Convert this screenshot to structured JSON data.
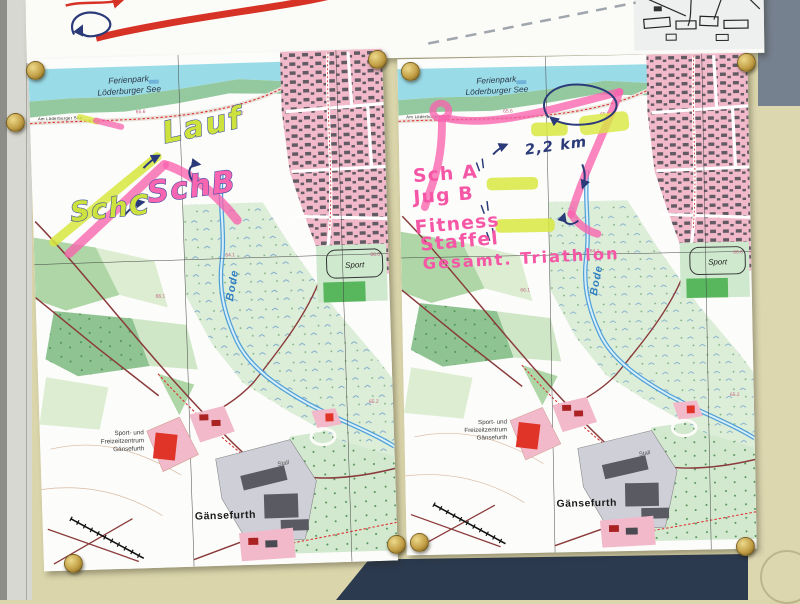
{
  "wall": {
    "base_color": "#dbd5ab",
    "left_frame_color": "#d8d8d2",
    "slate_color": "#76818f",
    "navy_panel_color": "#2c3a50",
    "pin_color": "#c3a047"
  },
  "base_map": {
    "ferienpark": {
      "line1": "Ferienpark",
      "line2": "Löderburger See"
    },
    "street": "Am Löderburger See",
    "river": "Bode",
    "sport": "Sport",
    "freizeitzentrum": {
      "line1": "Sport- und",
      "line2": "Freizeitzentrum",
      "line3": "Gänsefurth"
    },
    "stall": "Stall",
    "town": "Gänsefurth",
    "elevations": {
      "e1": "65.7",
      "e2": "64.1",
      "e3": "66.1",
      "e4": "66.0",
      "e5": "65.2",
      "e6": "65.6"
    }
  },
  "left_map": {
    "labels": {
      "lauf": "Lauf",
      "sch_b": "SchB",
      "sch_c": "SchC"
    },
    "marker_yellow": "#d7e73f",
    "marker_pink": "#f863ae",
    "pen_blue": "#2b3a78"
  },
  "right_map": {
    "labels": {
      "sch_a": "Sch A",
      "jug_b": "Jug B",
      "fitness": "Fitness",
      "staffel": "Staffel",
      "gesamt_triathlon": "Gesamt. Triathlon",
      "distance": "2,2 km"
    },
    "marker_pink": "#f556a6",
    "pen_blue": "#2b3a78"
  },
  "upper_map": {
    "route_color": "#d63226"
  }
}
